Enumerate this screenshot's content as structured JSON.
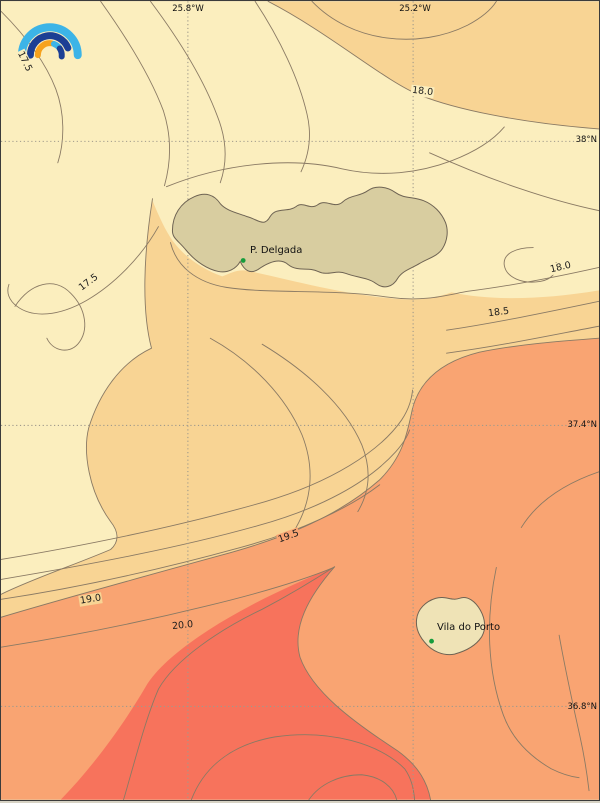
{
  "map": {
    "axis_ticks": {
      "top": [
        {
          "label": "25.8°W"
        },
        {
          "label": "25.2°W"
        }
      ],
      "right": [
        {
          "label": "38°N"
        },
        {
          "label": "37.4°N"
        },
        {
          "label": "36.8°N"
        }
      ]
    },
    "contour_levels": [
      "17.5",
      "18.0",
      "18.5",
      "19.0",
      "19.5",
      "20.0"
    ],
    "contour_labels": [
      {
        "value": "17.5"
      },
      {
        "value": "17.5"
      },
      {
        "value": "18.0"
      },
      {
        "value": "18.0"
      },
      {
        "value": "18.5"
      },
      {
        "value": "19.5"
      },
      {
        "value": "19.0"
      },
      {
        "value": "20.0"
      }
    ],
    "cities": [
      {
        "name": "P. Delgada"
      },
      {
        "name": "Vila do Porto"
      }
    ],
    "colors": {
      "zone_coolest": "#FBEEBE",
      "zone_mild": "#F8D494",
      "zone_warm": "#F9A472",
      "zone_hot": "#F7735C",
      "island_large": "#D8CDA0",
      "island_small": "#EFE3B6",
      "contour_line": "#8A7A64",
      "grid_line": "#A09A8C",
      "city_dot": "#169C3C",
      "frame": "#3B3B3B"
    },
    "logo": {
      "arc_colors": [
        "#3CB4E7",
        "#1C3F94",
        "#F6A21D"
      ]
    }
  },
  "chart_data": {
    "type": "heatmap",
    "subtype": "filled-contour-map",
    "contour_levels": [
      17.5,
      18.0,
      18.5,
      19.0,
      19.5,
      20.0
    ],
    "longitude_ticks": [
      "25.8°W",
      "25.2°W"
    ],
    "latitude_ticks": [
      "38°N",
      "37.4°N",
      "36.8°N"
    ],
    "labeled_places": [
      "P. Delgada",
      "Vila do Porto"
    ],
    "value_gradient": "values increase from top-left (17.5) to bottom-center (>20.0)"
  }
}
